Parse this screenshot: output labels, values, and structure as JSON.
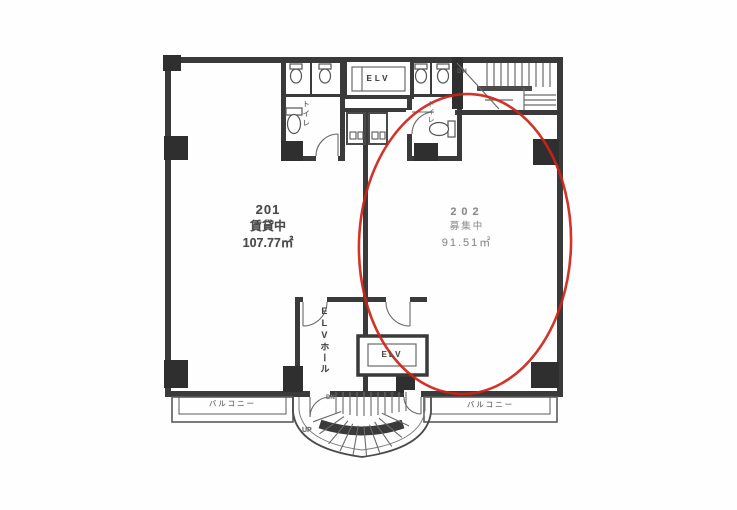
{
  "plan": {
    "units": [
      {
        "number": "201",
        "status": "賃貸中",
        "area": "107.77㎡"
      },
      {
        "number": "202",
        "status": "募集中",
        "area": "91.51㎡"
      }
    ],
    "labels": {
      "elevator_top": "ELV",
      "elevator_bottom": "ELV",
      "elevator_hall": "ELVホール",
      "toilet_left": "トイレ",
      "toilet_right": "トイレ",
      "balcony_left": "バルコニー",
      "balcony_right": "バルコニー",
      "stairs_down_top": "DN",
      "stairs_down_bottom": "DN",
      "stairs_up_bottom": "UP"
    },
    "annotation": {
      "shape": "ellipse",
      "color": "#cf2318",
      "highlights_unit": "202"
    },
    "colors": {
      "wall": "#3a3a3a",
      "thin_line": "#6a6a6a",
      "highlight": "#cf2318",
      "text": "#4a4a4a",
      "faded_text": "#8b8b8b"
    }
  }
}
